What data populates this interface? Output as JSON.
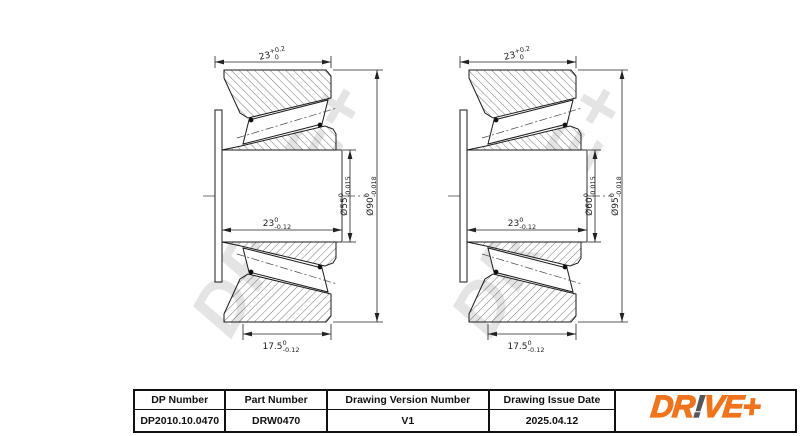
{
  "drawing": {
    "watermark": "DR!VE+",
    "bearings": [
      {
        "id": "left-bearing",
        "dims": {
          "total_width": {
            "main": "23",
            "sup": "+0.2",
            "sub": "0"
          },
          "bore": {
            "main": "Ø55",
            "sup": "0",
            "sub": "-0.015"
          },
          "outer_diameter": {
            "main": "Ø90",
            "sup": "0",
            "sub": "-0.018"
          },
          "inner_ring_width": {
            "main": "23",
            "sup": "0",
            "sub": "-0.12"
          },
          "outer_ring_width": {
            "main": "17.5",
            "sup": "0",
            "sub": "-0.12"
          }
        }
      },
      {
        "id": "right-bearing",
        "dims": {
          "total_width": {
            "main": "23",
            "sup": "+0.2",
            "sub": "0"
          },
          "bore": {
            "main": "Ø60",
            "sup": "0",
            "sub": "-0.015"
          },
          "outer_diameter": {
            "main": "Ø95",
            "sup": "0",
            "sub": "-0.018"
          },
          "inner_ring_width": {
            "main": "23",
            "sup": "0",
            "sub": "-0.12"
          },
          "outer_ring_width": {
            "main": "17.5",
            "sup": "0",
            "sub": "-0.12"
          }
        }
      }
    ]
  },
  "title_block": {
    "columns": [
      {
        "header": "DP Number",
        "value": "DP2010.10.0470"
      },
      {
        "header": "Part Number",
        "value": "DRW0470"
      },
      {
        "header": "Drawing Version Number",
        "value": "V1"
      },
      {
        "header": "Drawing Issue Date",
        "value": "2025.04.12"
      }
    ],
    "logo": {
      "part1": "DR",
      "bang": "!",
      "part2": "VE",
      "plus": "+",
      "orange": "#F0741D",
      "gray": "#56565A"
    }
  }
}
